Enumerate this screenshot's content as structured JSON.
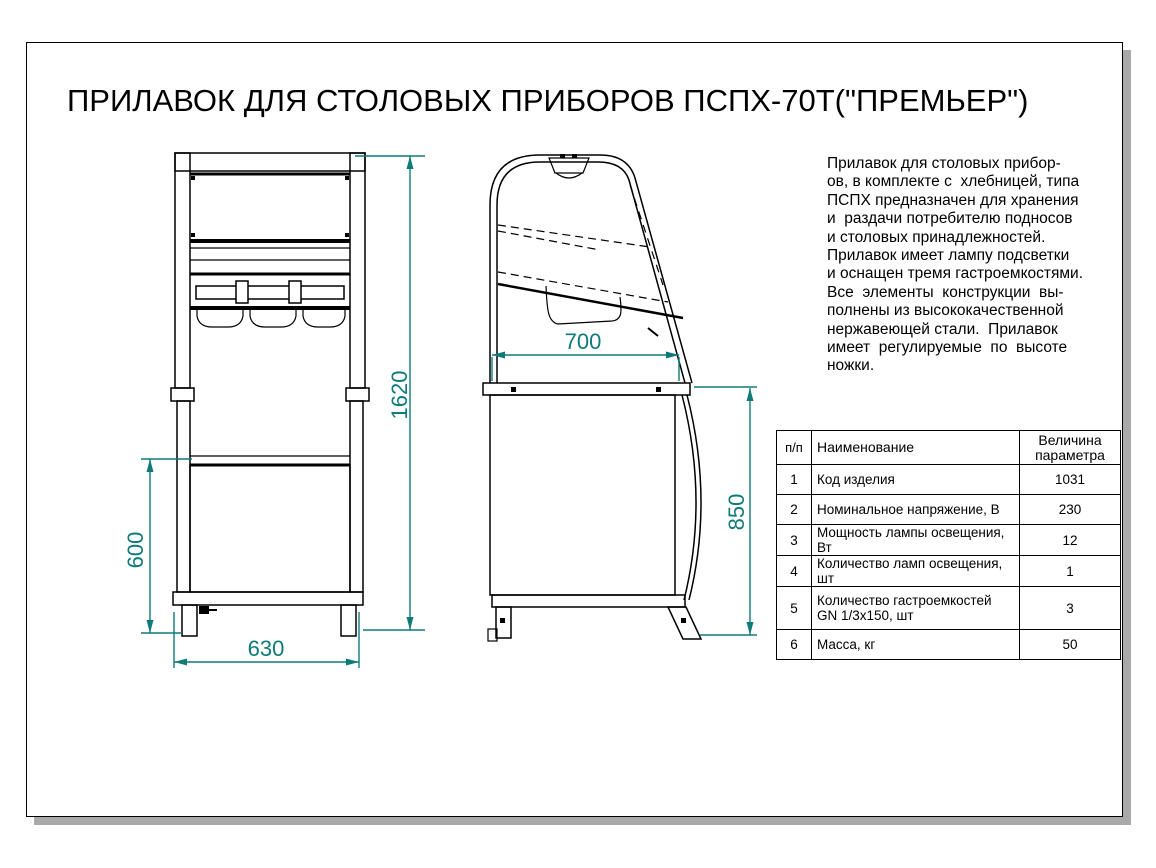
{
  "sheet": {
    "title": "ПРИЛАВОК ДЛЯ СТОЛОВЫХ ПРИБОРОВ ПСПХ-70Т(\"ПРЕМЬЕР\")"
  },
  "description": {
    "lines": [
      "Прилавок для столовых прибор-",
      "ов, в комплекте с  хлебницей, типа",
      "ПСПХ предназначен для хранения",
      "и  раздачи потребителю подносов",
      "и столовых принадлежностей.",
      "Прилавок имеет лампу подсветки",
      "и оснащен тремя гастроемкостями.",
      "Все  элементы  конструкции  вы-",
      "полнены из высококачественной",
      "нержавеющей стали.  Прилавок",
      "имеет  регулируемые  по  высоте",
      "ножки."
    ]
  },
  "dimensions": {
    "overall_height": "1620",
    "base_height": "600",
    "base_width": "630",
    "counter_depth": "700",
    "counter_height": "850"
  },
  "table": {
    "headers": {
      "num": "п/п",
      "name": "Наименование",
      "value_line1": "Величина",
      "value_line2": "параметра"
    },
    "rows": [
      {
        "num": "1",
        "name": "Код изделия",
        "name2": "",
        "value": "1031"
      },
      {
        "num": "2",
        "name": "Номинальное напряжение, В",
        "name2": "",
        "value": "230"
      },
      {
        "num": "3",
        "name": "Мощность лампы освещения, Вт",
        "name2": "",
        "value": "12"
      },
      {
        "num": "4",
        "name": "Количество ламп освещения, шт",
        "name2": "",
        "value": "1"
      },
      {
        "num": "5",
        "name": "Количество гастроемкостей",
        "name2": "GN 1/3x150, шт",
        "value": "3"
      },
      {
        "num": "6",
        "name": "Масса, кг",
        "name2": "",
        "value": "50"
      }
    ]
  },
  "colors": {
    "dimension": "#0f7a7a",
    "line": "#000000",
    "shadow": "#a9a9a9"
  }
}
